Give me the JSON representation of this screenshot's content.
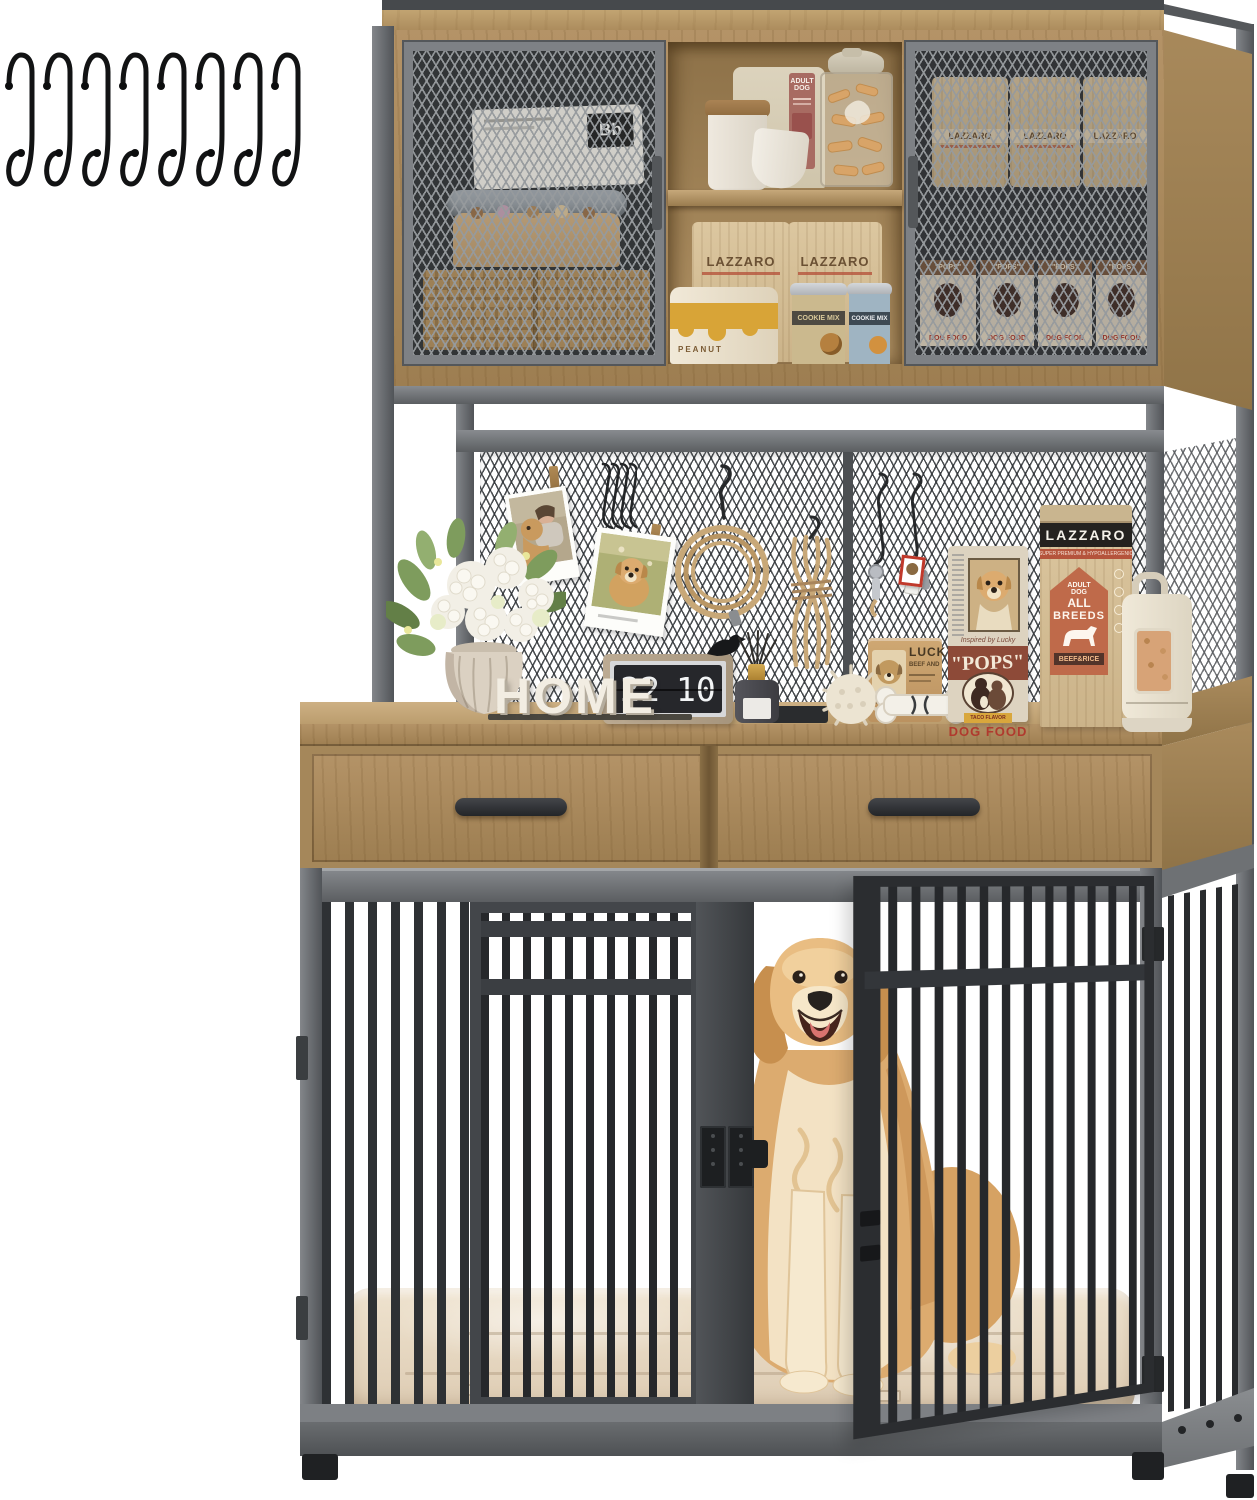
{
  "meta": {
    "description": "Product photo: dog crate furniture with mesh-door storage hutch, pegboard shelf, two drawers and barred crate with golden retriever",
    "canvas": {
      "width": 1257,
      "height": 1500
    }
  },
  "colors": {
    "wood": "#b59264",
    "wood_dark": "#97794f",
    "frame_gray": "#6f7276",
    "bar_dark": "#2b2d30",
    "kraft": "#d9c6a0",
    "accent_red": "#b5543c",
    "badge_terracotta": "#bf6a4a",
    "cushion_beige": "#e8dac6",
    "dog_gold": "#dcab6f"
  },
  "hardware": {
    "s_hook_count": 8
  },
  "hutch": {
    "bb_bag_label": "Bb",
    "treat_bag_label_line1": "ADULT",
    "treat_bag_label_line2": "DOG",
    "kraft_bag_brand": "LAZZARO",
    "peanut_jar_label": "PEANUT",
    "cookie_tin_label": "COOKIE MIX",
    "pops_bag_title": "\"POPS\"",
    "pops_bag_subtitle": "DOG FOOD"
  },
  "display": {
    "home_sign": "HOME",
    "clock_hours": "22",
    "clock_minutes": "10",
    "lucky_can_title": "LUCKY",
    "lucky_can_line": "BEEF AND",
    "pops_can_caption": "Inspired by Lucky",
    "pops_can_title": "\"POPS\"",
    "pops_can_flavor": "TACO FLAVOR",
    "pops_can_type": "DOG FOOD",
    "food_bag_brand": "LAZZARO",
    "food_bag_subtitle": "SUPER PREMIUM & HYPOALLERGENIC",
    "food_bag_badge_line1": "ADULT",
    "food_bag_badge_line2": "DOG",
    "food_bag_badge_line3": "ALL",
    "food_bag_badge_line4": "BREEDS",
    "food_bag_flavor": "BEEF&RICE"
  }
}
